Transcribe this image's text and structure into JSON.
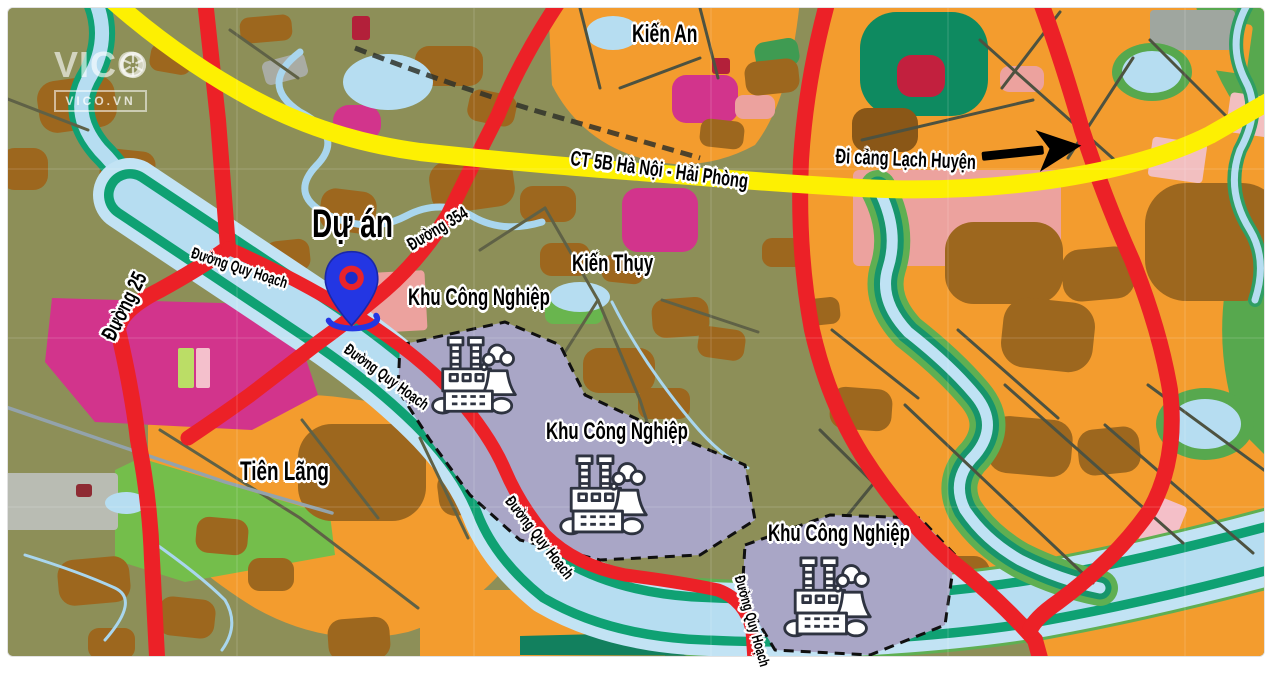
{
  "watermark": {
    "brand": "VICO",
    "domain": "VICO.VN"
  },
  "labels": {
    "kien_an": "Kiến An",
    "kien_thuy": "Kiến Thụy",
    "tien_lang": "Tiên Lãng",
    "du_an": "Dự án",
    "highway": "CT 5B Hà Nội - Hải Phòng",
    "port_direction": "Đi cảng Lạch Huyện",
    "duong_354": "Đường 354",
    "duong_25": "Đường 25",
    "duong_quy_hoach_1": "Đường Quy Hoạch",
    "duong_quy_hoach_2": "Đường Quy Hoạch",
    "duong_quy_hoach_3": "Đường Quy Hoạch",
    "duong_quy_hoach_4": "Đường Quy Hoạch",
    "khu_cong_nghiep_1": "Khu Công Nghiệp",
    "khu_cong_nghiep_2": "Khu Công Nghiệp",
    "khu_cong_nghiep_3": "Khu Công Nghiệp"
  },
  "icons": {
    "project_marker": "map-pin",
    "industrial_zone": "factory",
    "port_direction": "arrow-right",
    "watermark_logo": "camera-aperture"
  },
  "colors": {
    "highway_yellow": "#FDF002",
    "road_red": "#EC2127",
    "river_blue": "#B6DDF1",
    "river_bank_teal": "#0FA173",
    "residential_orange": "#F39C2E",
    "field_olive": "#8D8F58",
    "village_brown": "#9D671E",
    "industrial_lavender": "#A9A6C6",
    "planning_magenta": "#D2348C",
    "urban_salmon": "#ECA29E",
    "marker_blue": "#2336E3"
  }
}
